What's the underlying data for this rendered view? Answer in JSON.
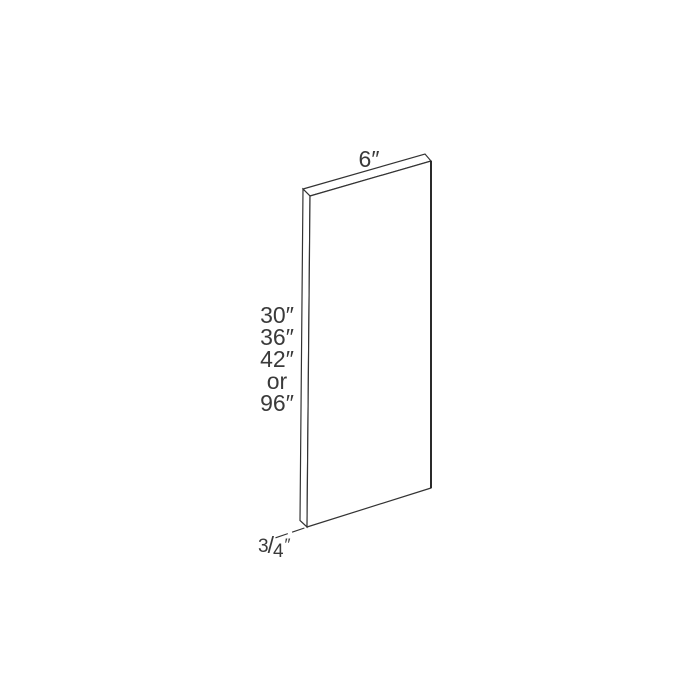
{
  "diagram": {
    "description_labels": {
      "width_label": "6″",
      "height_lines": [
        "30″",
        "36″",
        "42″",
        "or",
        "96″"
      ],
      "thickness_label": {
        "numerator": "3",
        "slash": "/",
        "denominator": "4",
        "unit_mark": "″"
      }
    },
    "colors": {
      "background": "#ffffff",
      "panel_face": "#ffffff",
      "outline": "#333333",
      "outline_dark": "#222222",
      "text": "#3a3a3a"
    }
  }
}
